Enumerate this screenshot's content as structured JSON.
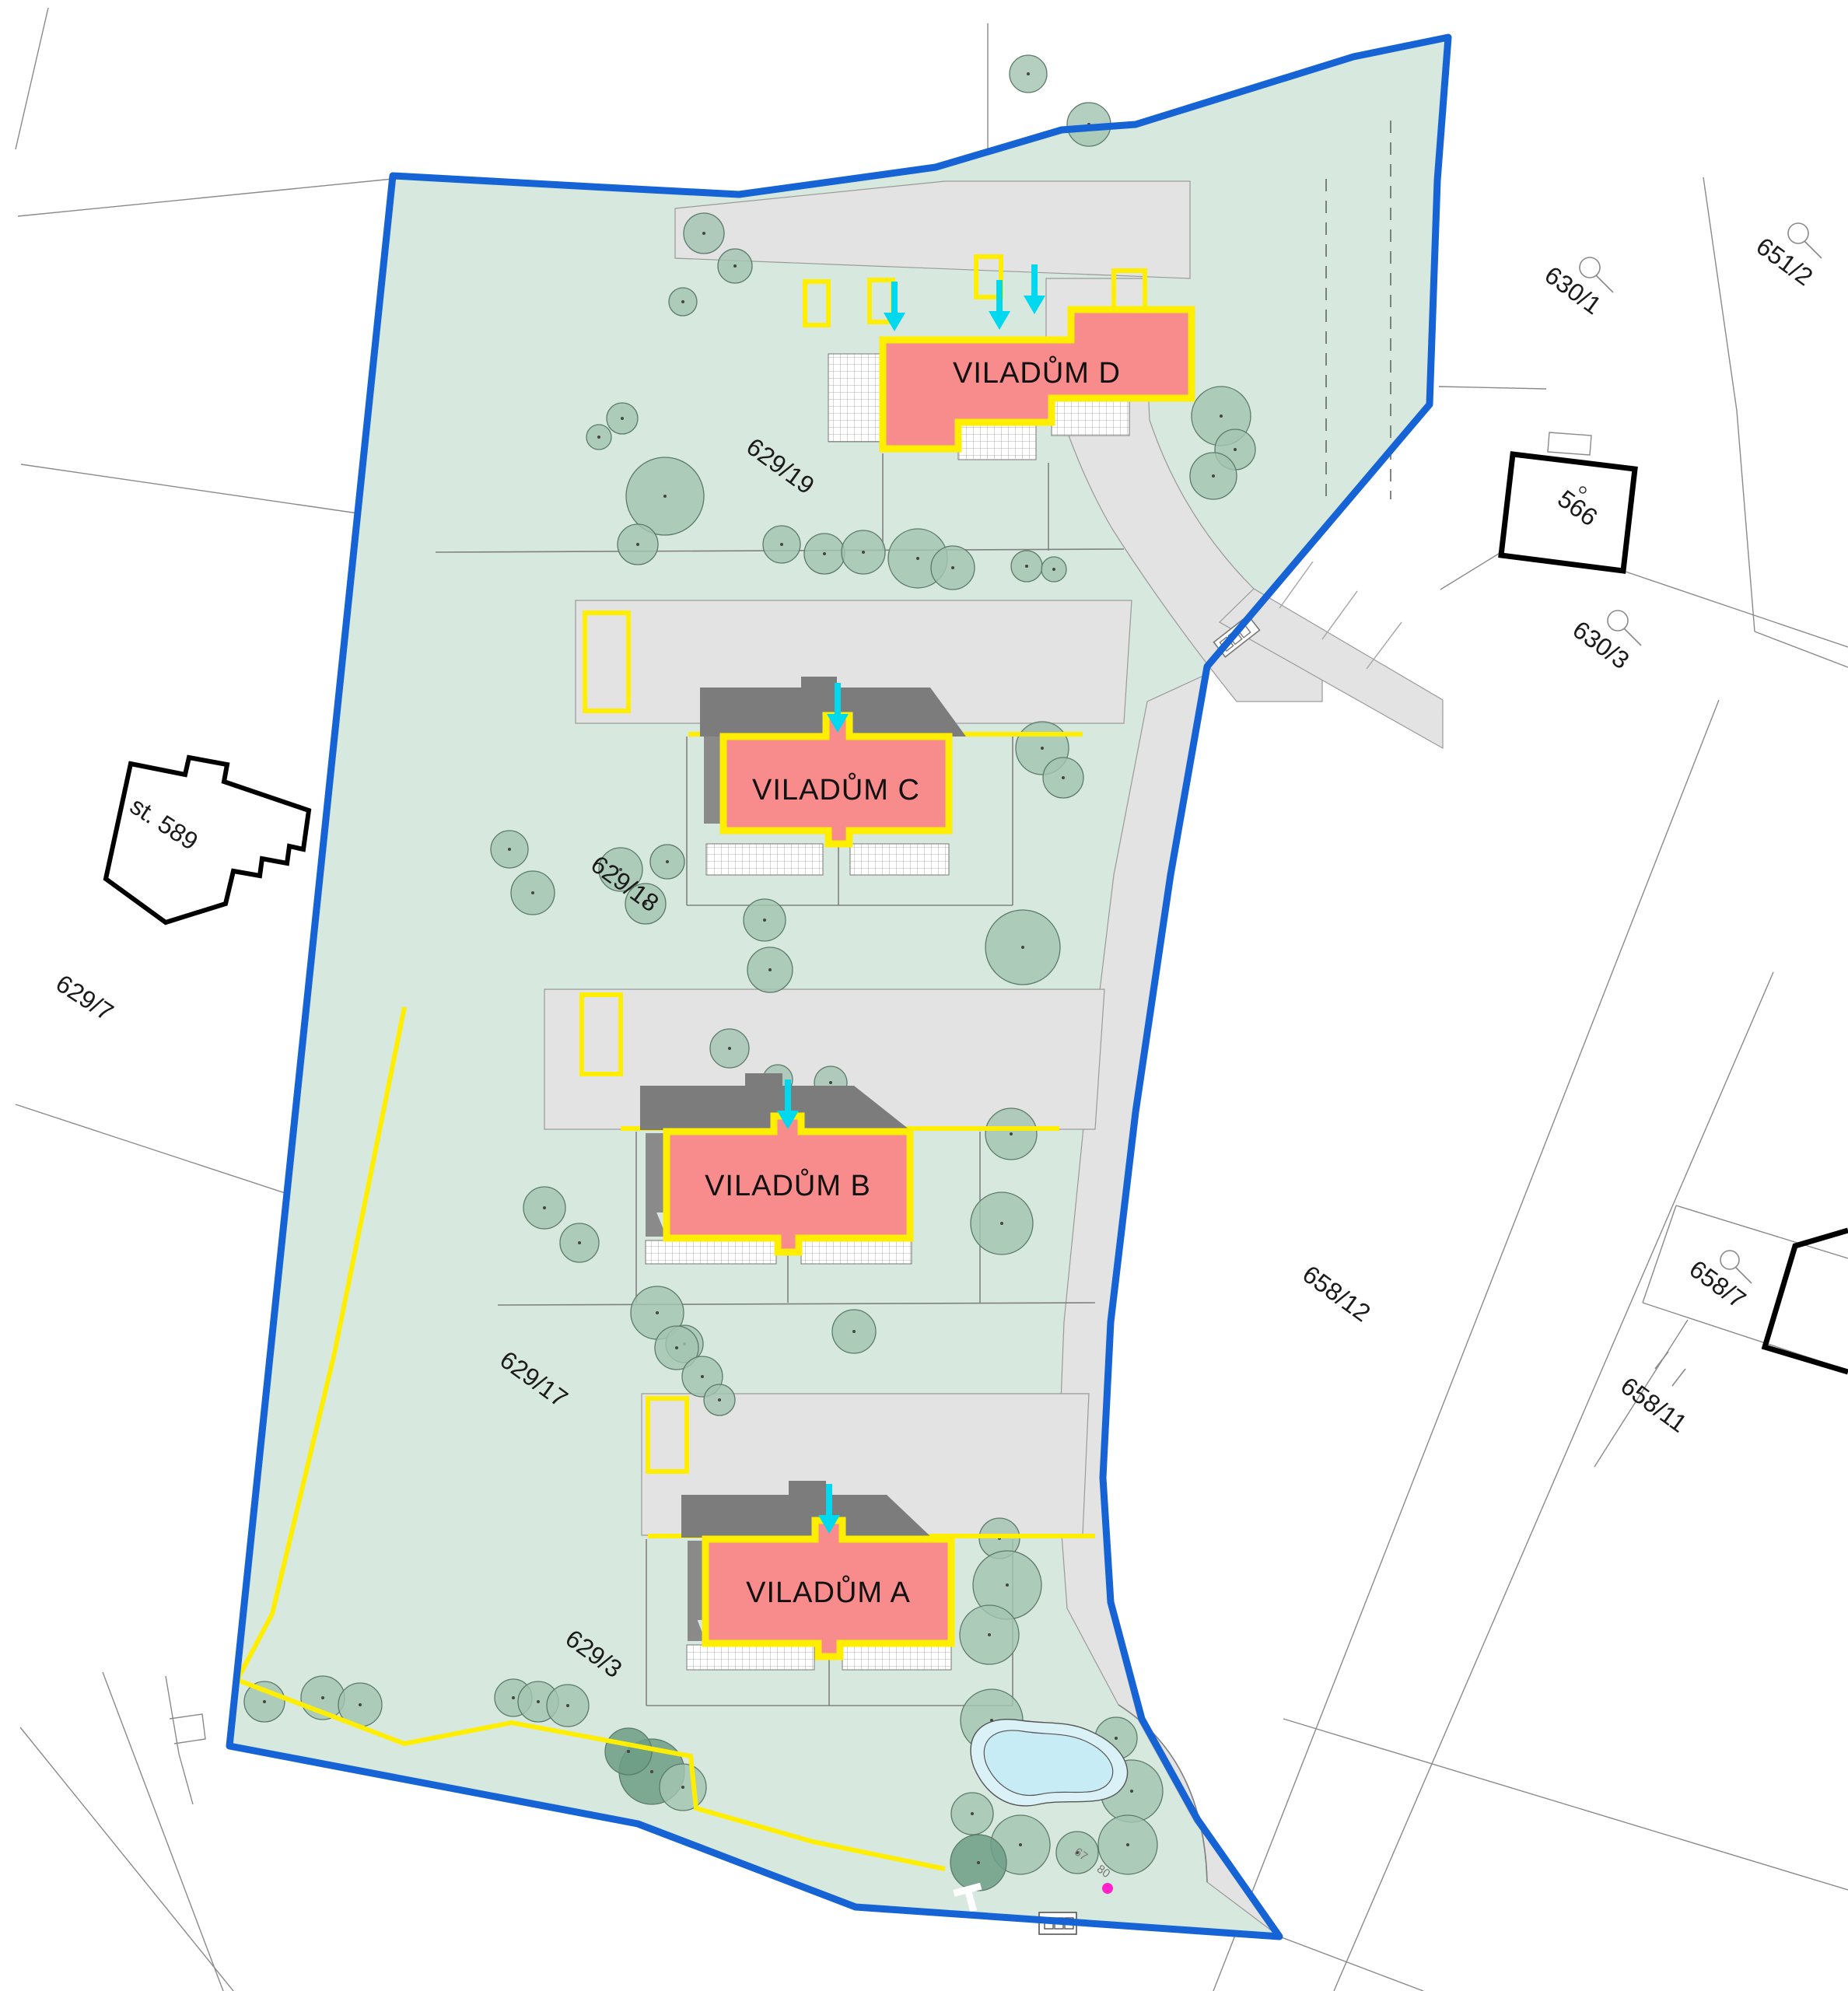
{
  "map": {
    "type": "architectural site plan / cadastral map",
    "site_boundary_color": "#1563d5",
    "colors": {
      "site_green": "#d7e8de",
      "road_gray": "#e3e3e3",
      "building_pink": "#f88b8b",
      "building_outline_yellow": "#ffee00",
      "boundary_blue": "#1563d5",
      "entrance_arrow_cyan": "#00d8f0",
      "roof_shadow_gray": "#7c7c7c",
      "tree_green": "#a3c4b1",
      "pond_blue": "#daf1f8",
      "survey_point_magenta": "#ff22cc",
      "parcel_line_gray": "#8a8a8a",
      "label_black": "#1a1a1a"
    }
  },
  "buildings": [
    {
      "id": "viladum-a",
      "label": "VILADŮM A"
    },
    {
      "id": "viladum-b",
      "label": "VILADŮM B"
    },
    {
      "id": "viladum-c",
      "label": "VILADŮM C"
    },
    {
      "id": "viladum-d",
      "label": "VILADŮM D"
    }
  ],
  "neighbor_buildings": [
    {
      "label": "566"
    },
    {
      "label": "st. 589"
    }
  ],
  "parcels": [
    {
      "label": "651/2",
      "has_loop_marker": true
    },
    {
      "label": "630/1",
      "has_loop_marker": true
    },
    {
      "label": "630/3",
      "has_loop_marker": true
    },
    {
      "label": "629/19"
    },
    {
      "label": "629/18"
    },
    {
      "label": "629/17"
    },
    {
      "label": "629/3"
    },
    {
      "label": "629/7"
    },
    {
      "label": "658/12"
    },
    {
      "label": "658/7",
      "has_loop_marker": true
    },
    {
      "label": "658/11",
      "has_boundary_slashes": true
    }
  ],
  "small_numbers": [
    "67",
    "80"
  ],
  "icons": {
    "entrance_arrow": "cyan-down-arrow",
    "parcel_loop": "circle-with-tail",
    "tree": "green-circle-with-center-dot",
    "bin_shelter": "rectangle-with-three-cells",
    "vehicle": "rotated-rectangle-with-cells"
  }
}
